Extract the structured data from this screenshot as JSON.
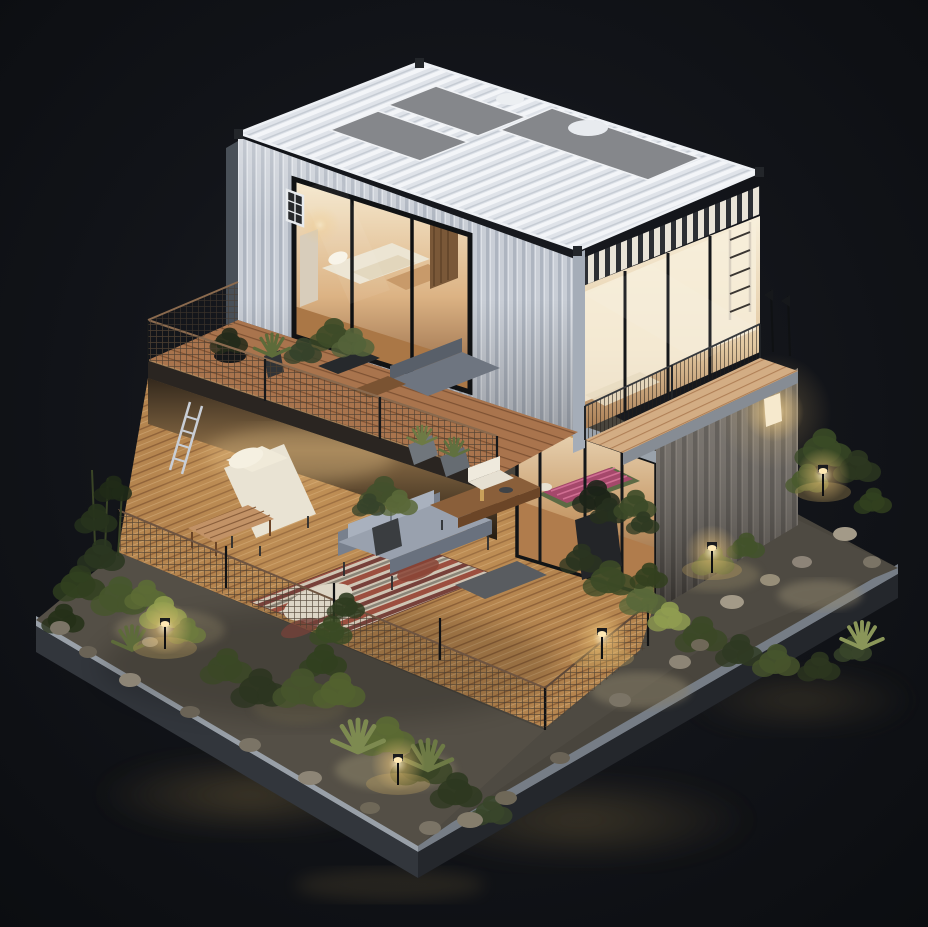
{
  "meta": {
    "type": "3d-render",
    "subject": "Isometric miniature model of a two-story shipping-container house at night",
    "setting": "dark charcoal studio floor, warm interior and garden lighting",
    "style": "architectural diorama, night scene"
  },
  "palette": {
    "background": "#0c0e12",
    "container_white": "#c9ced6",
    "container_white_rib": "#aeb5c0",
    "roof_white": "#dfe3e9",
    "roof_ridge": "#f3f5f8",
    "roof_gravel": "#85878b",
    "container_gray": "#6b655e",
    "container_gray_rib": "#524d47",
    "glass_warm_bright": "#f8f0dc",
    "glass_warm_mid": "#e0c29a",
    "glass_warm_deep": "#9a6f4a",
    "wood_deck": "#b5854f",
    "wood_plank_line": "#8f6239",
    "wood_terrace": "#a9744d",
    "wood_balcony": "#d3ad84",
    "fascia_dark": "#2a2521",
    "concrete_rim_light": "#99a0a8",
    "concrete_rim_shade": "#767d86",
    "platform_side": "#32363c",
    "gravel_dark": "#544f46",
    "stone": "#8d8576",
    "foliage_dark": "#2c3720",
    "foliage_mid": "#46542c",
    "foliage_lit": "#8f9c4e",
    "light_warm": "#ffe9b4",
    "sofa_gray": "#99a1ae",
    "chaise_cream": "#e9e3d3",
    "rug_red": "#9c4f3f",
    "rug_cream": "#cfc5b4",
    "mattress_pink": "#a5486b",
    "metal_dark": "#1b1d20"
  },
  "scene": {
    "description": "A two-story container home model: a white corrugated container (upper bedroom with glazed walls and gravel roof trays) stacked over a gray corrugated container, with a plant-filled wooden terrace, a ground-floor open deck with lounge furniture and a patterned rug, all on a landscaped concrete platform with shrubs, rocks and glowing path lights.",
    "objects": [
      "white corrugated container - upper floor bedroom",
      "gravel roof trays on container roof",
      "glazed bedroom wall with sliding doors",
      "small white-grid window",
      "second-floor wooden terrace with wire-mesh railing",
      "terrace potted plants and gray lounge set",
      "gray corrugated container - ground floor right",
      "wall lamp on gray container",
      "balcony with thin antenna posts",
      "ground-floor glass room with floor mattress and magenta blanket",
      "open wooden deck with gray sofa, cream chaise, slat coffee table, console table",
      "patterned area rug with sheepskin",
      "white ladder to terrace",
      "wire-mesh deck fence",
      "landscaped platform: gravel, boulders, shrubs, agaves",
      "five warm path lights",
      "dark reflective studio floor"
    ]
  }
}
